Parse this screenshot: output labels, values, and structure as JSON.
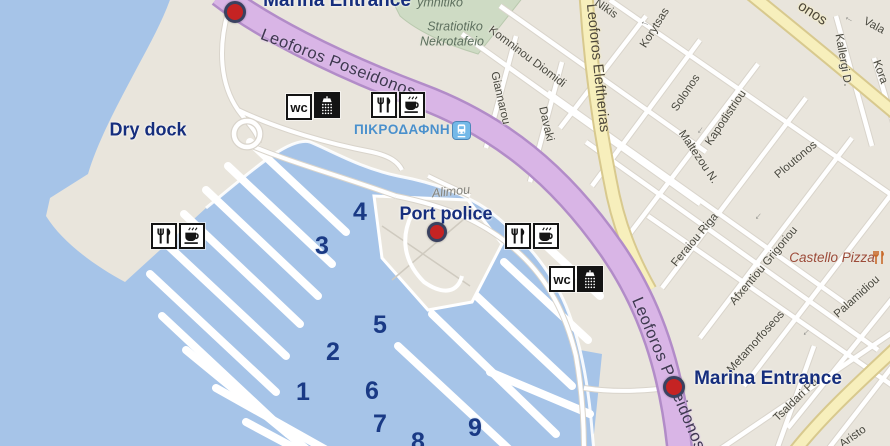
{
  "colors": {
    "water": "#a6c4e8",
    "land": "#e9e5dc",
    "cemetery_green": "#cedbc4",
    "road_purple": "#d9b5e6",
    "road_purple_casing": "#b28cc8",
    "road_yellow": "#f7efbc",
    "road_yellow_casing": "#d8c98e",
    "road_white_casing": "#d9d4cb",
    "marker_red": "#c52323",
    "label_navy": "#162e7d",
    "pier_number_navy": "#1a3a85",
    "station_blue": "#4a90cc"
  },
  "icons": {
    "wc_glyph": "wc"
  },
  "big_labels": [
    {
      "text": "Marina Entrance",
      "x": 337,
      "y": 1,
      "big": true,
      "name": "marina-entrance-label-top"
    },
    {
      "text": "Dry dock",
      "x": 148,
      "y": 130,
      "big": false,
      "name": "dry-dock-label"
    },
    {
      "text": "Port police",
      "x": 446,
      "y": 214,
      "big": false,
      "name": "port-police-label"
    },
    {
      "text": "Marina Entrance",
      "x": 768,
      "y": 379,
      "big": true,
      "name": "marina-entrance-label-bottom"
    }
  ],
  "cemetery": {
    "line1": "ymnitiko",
    "line2": "Stratiotiko",
    "line3": "Nekrotafeio"
  },
  "station": {
    "name": "ΠΙΚΡΟΔΑΦΝΗ"
  },
  "poi": {
    "castello_pizza": "Castello Pizza"
  },
  "pier_numbers": [
    {
      "n": "1",
      "x": 303,
      "y": 392
    },
    {
      "n": "2",
      "x": 333,
      "y": 352
    },
    {
      "n": "3",
      "x": 322,
      "y": 246
    },
    {
      "n": "4",
      "x": 360,
      "y": 212
    },
    {
      "n": "5",
      "x": 380,
      "y": 325
    },
    {
      "n": "6",
      "x": 372,
      "y": 391
    },
    {
      "n": "7",
      "x": 380,
      "y": 424
    },
    {
      "n": "8",
      "x": 418,
      "y": 442
    },
    {
      "n": "9",
      "x": 475,
      "y": 428
    }
  ],
  "street_labels": [
    {
      "text": "Leoforos Poseidonos",
      "x": 338,
      "y": 64,
      "rot": 21,
      "cls": "road-major"
    },
    {
      "text": "Leoforos Poseidonos",
      "x": 668,
      "y": 374,
      "rot": 67,
      "cls": "road-major"
    },
    {
      "text": "Leoforos Eleftherias",
      "x": 597,
      "y": 68,
      "rot": 84,
      "cls": "road-yellow"
    },
    {
      "text": "onos",
      "x": 812,
      "y": 14,
      "rot": 33,
      "cls": "road-yellow"
    },
    {
      "text": "Nikis",
      "x": 606,
      "y": 9,
      "rot": 35,
      "cls": "street"
    },
    {
      "text": "Korytsas",
      "x": 655,
      "y": 28,
      "rot": -58,
      "cls": "street"
    },
    {
      "text": "Komninou Diomidi",
      "x": 527,
      "y": 57,
      "rot": 37,
      "cls": "street"
    },
    {
      "text": "Giannarou",
      "x": 500,
      "y": 98,
      "rot": 77,
      "cls": "street"
    },
    {
      "text": "Davaki",
      "x": 546,
      "y": 124,
      "rot": 77,
      "cls": "street"
    },
    {
      "text": "Solonos",
      "x": 686,
      "y": 93,
      "rot": -56,
      "cls": "street"
    },
    {
      "text": "Kapodistriou",
      "x": 726,
      "y": 118,
      "rot": -56,
      "cls": "street"
    },
    {
      "text": "Maltezou N.",
      "x": 698,
      "y": 157,
      "rot": 56,
      "cls": "street"
    },
    {
      "text": "Ploutonos",
      "x": 796,
      "y": 160,
      "rot": -40,
      "cls": "street"
    },
    {
      "text": "Feraiou Riga",
      "x": 695,
      "y": 240,
      "rot": -50,
      "cls": "street"
    },
    {
      "text": "Afxentiou Grigoriou",
      "x": 764,
      "y": 266,
      "rot": -50,
      "cls": "street"
    },
    {
      "text": "Metamorfoseos",
      "x": 756,
      "y": 342,
      "rot": -48,
      "cls": "street"
    },
    {
      "text": "Palamidiou",
      "x": 857,
      "y": 297,
      "rot": -42,
      "cls": "street"
    },
    {
      "text": "Tsaldari Pa",
      "x": 796,
      "y": 400,
      "rot": -44,
      "cls": "street"
    },
    {
      "text": "Aristo",
      "x": 853,
      "y": 437,
      "rot": -35,
      "cls": "street"
    },
    {
      "text": "Kallergi D.",
      "x": 843,
      "y": 60,
      "rot": 80,
      "cls": "street"
    },
    {
      "text": "Vala",
      "x": 874,
      "y": 26,
      "rot": 28,
      "cls": "street"
    },
    {
      "text": "Kora",
      "x": 880,
      "y": 72,
      "rot": 70,
      "cls": "street"
    },
    {
      "text": "Alimou",
      "x": 451,
      "y": 192,
      "rot": -6,
      "cls": "street-italic"
    },
    {
      "text": "←",
      "x": 516,
      "y": 49,
      "rot": 38,
      "cls": "arrow"
    },
    {
      "text": "←",
      "x": 645,
      "y": 23,
      "rot": 20,
      "cls": "arrow"
    },
    {
      "text": "←",
      "x": 849,
      "y": 19,
      "rot": 30,
      "cls": "arrow"
    },
    {
      "text": "←",
      "x": 700,
      "y": 130,
      "rot": -55,
      "cls": "arrow"
    },
    {
      "text": "←",
      "x": 758,
      "y": 216,
      "rot": -50,
      "cls": "arrow"
    },
    {
      "text": "←",
      "x": 806,
      "y": 332,
      "rot": -45,
      "cls": "arrow"
    }
  ],
  "amenity_icons": [
    {
      "type": "wc",
      "x": 286,
      "y": 94
    },
    {
      "type": "shower",
      "x": 314,
      "y": 92
    },
    {
      "type": "restaurant",
      "x": 371,
      "y": 92
    },
    {
      "type": "cafe",
      "x": 399,
      "y": 92
    },
    {
      "type": "restaurant",
      "x": 505,
      "y": 223
    },
    {
      "type": "cafe",
      "x": 533,
      "y": 223
    },
    {
      "type": "wc",
      "x": 549,
      "y": 266
    },
    {
      "type": "shower",
      "x": 577,
      "y": 266
    },
    {
      "type": "restaurant",
      "x": 151,
      "y": 223
    },
    {
      "type": "cafe",
      "x": 179,
      "y": 223
    }
  ],
  "markers": [
    {
      "name": "marina-entrance-marker-top",
      "x": 235,
      "y": 12,
      "small": false
    },
    {
      "name": "port-police-marker",
      "x": 437,
      "y": 232,
      "small": true
    },
    {
      "name": "marina-entrance-marker-bottom",
      "x": 674,
      "y": 387,
      "small": false
    }
  ]
}
